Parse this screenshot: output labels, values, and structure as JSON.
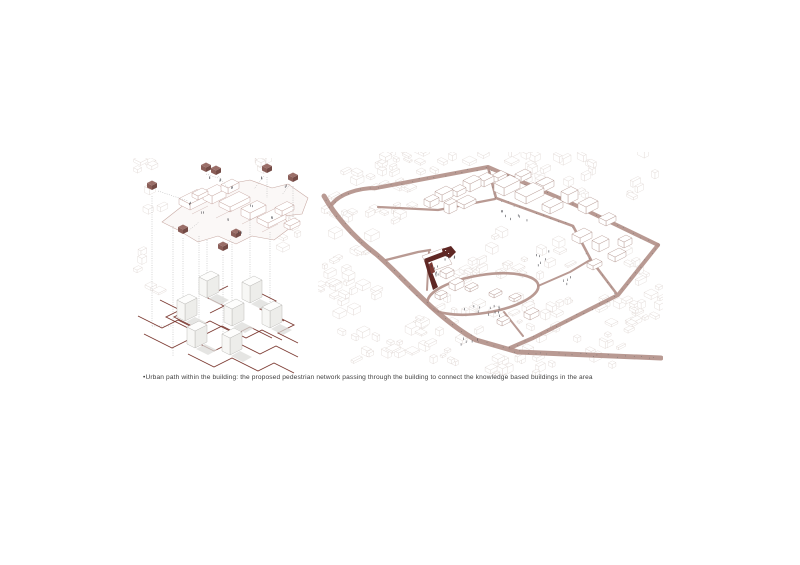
{
  "caption": {
    "text": "•Urban path within the building: the proposed pedestrian network passing through the building to connect the knowledge based buildings in the area"
  },
  "colors": {
    "page_bg": "#ffffff",
    "text": "#3f3f3f",
    "landmark_maroon": "#5f2724",
    "landmark_maroon_light": "#7c3a34",
    "cube_top": "#9b6f69",
    "cube_left": "#8a5e58",
    "cube_right": "#744b46",
    "network_red": "#7d3b33",
    "road_mauve": "#b3918a",
    "outline_faint": "#ddd3cf",
    "outline_building": "#b59a93",
    "outline_plan": "#c4a49d",
    "plan_fill": "#fbf8f7",
    "guide_gray": "#9b9b9b",
    "tower_stroke": "#b9b8b4",
    "tower_side": "#ededea",
    "tower_front": "#f7f7f5",
    "tower_top": "#fdfdfc",
    "shadow": "#dcdcd9",
    "figure_dark": "#3a3a40",
    "road_dot": "#6b6b6b"
  }
}
